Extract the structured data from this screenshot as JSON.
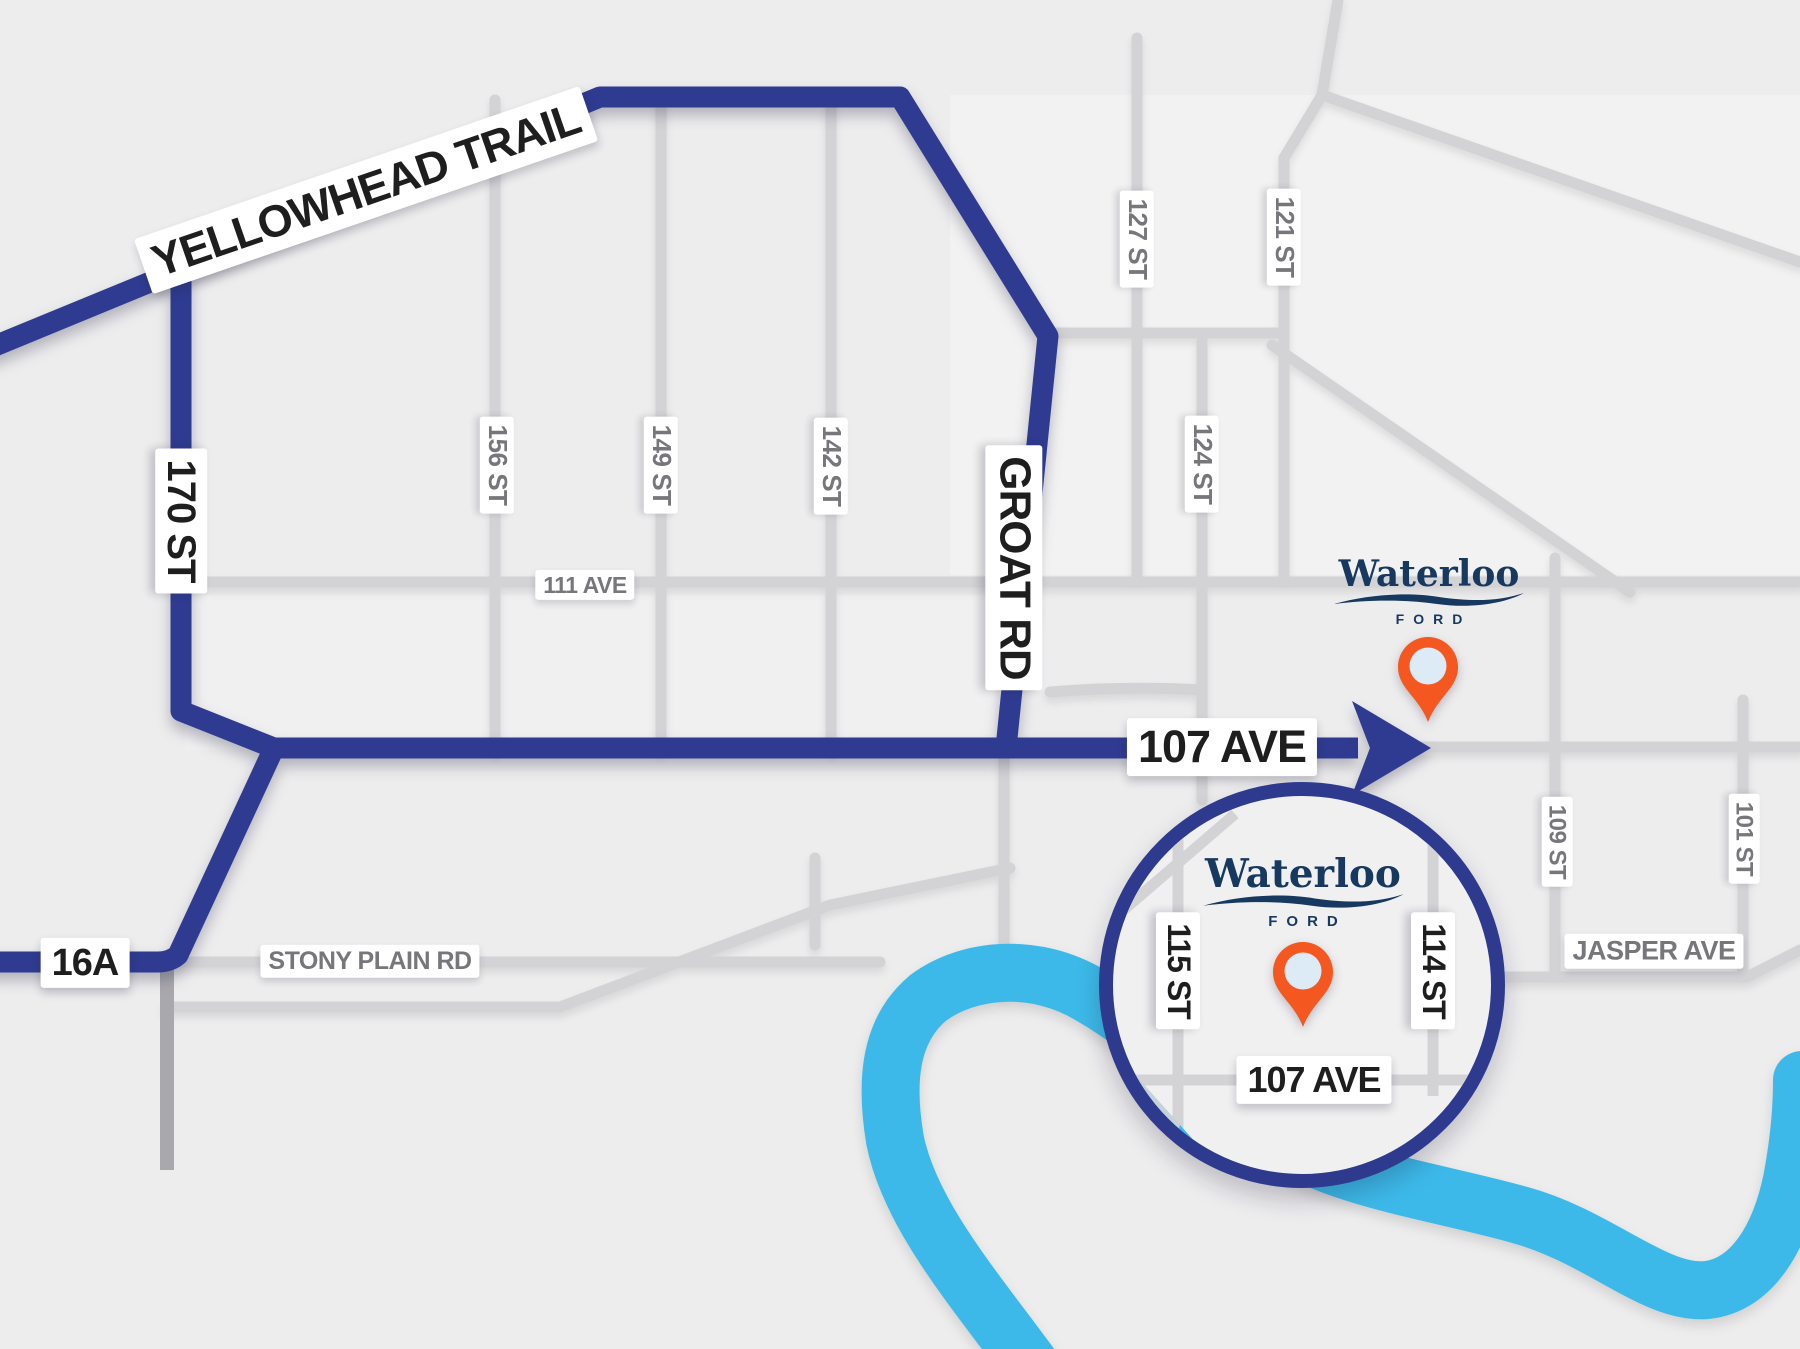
{
  "dealership": {
    "name": "Waterloo",
    "brand": "FORD"
  },
  "route_labels": {
    "yellowhead": "YELLOWHEAD TRAIL",
    "st_170": "170 ST",
    "groat_rd": "GROAT RD",
    "ave_107": "107 AVE",
    "hwy_16a": "16A"
  },
  "street_labels": {
    "st_156": "156 ST",
    "st_149": "149 ST",
    "st_142": "142 ST",
    "st_127": "127 ST",
    "st_121": "121 ST",
    "st_124": "124 ST",
    "ave_111": "111 AVE",
    "stony_plain": "STONY PLAIN RD",
    "jasper": "JASPER AVE",
    "st_109": "109 ST",
    "st_101": "101 ST"
  },
  "inset": {
    "st_115": "115 ST",
    "st_114": "114 ST",
    "ave_107": "107 AVE"
  },
  "colors": {
    "route_navy": "#2f3b90",
    "inset_border_navy": "#2e3a8e",
    "road_gray": "#d3d3d6",
    "road_dark_gray": "#a9a9ad",
    "river_blue": "#3db9e9",
    "pin_orange": "#f4571f",
    "pin_hole_blue": "#dcebf6",
    "logo_navy": "#17395f",
    "map_bg": "#ededee",
    "label_black": "#1e1e1f",
    "label_gray": "#76767b"
  }
}
